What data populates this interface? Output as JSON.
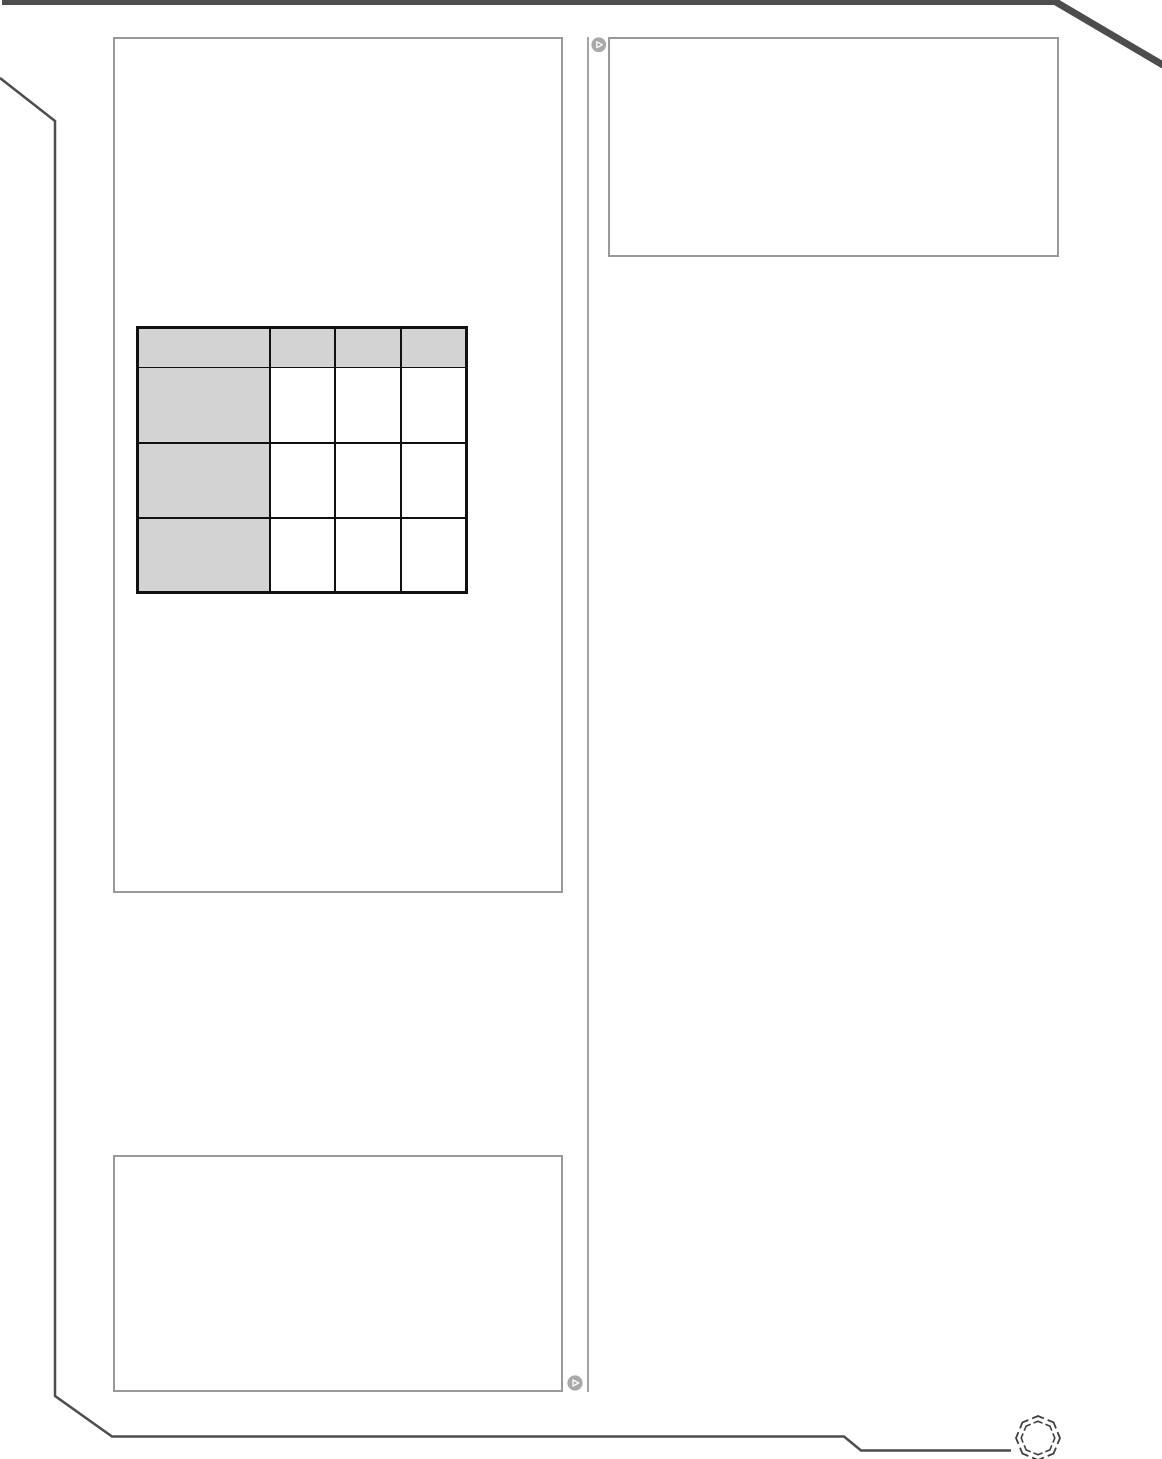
{
  "page": {
    "background": "#ffffff"
  },
  "frame": {
    "dark_color": "#4d4d4d",
    "box_border_color": "#999999",
    "divider_color": "#a3a3a3"
  },
  "icons": {
    "play_top": "play-icon",
    "play_bottom": "play-icon",
    "octagon_ring": "octagon-ring-icon",
    "play_fill": "#a9a9a9",
    "play_triangle_stroke": "#ffffff",
    "octagon_color": "#3f3f3f"
  },
  "table": {
    "header_fill": "#d3d3d3",
    "row_header_fill": "#d3d3d3",
    "border_color": "#111111",
    "columns": [
      "",
      "",
      "",
      ""
    ],
    "rows": [
      [
        "",
        "",
        "",
        ""
      ],
      [
        "",
        "",
        "",
        ""
      ],
      [
        "",
        "",
        "",
        ""
      ]
    ]
  }
}
